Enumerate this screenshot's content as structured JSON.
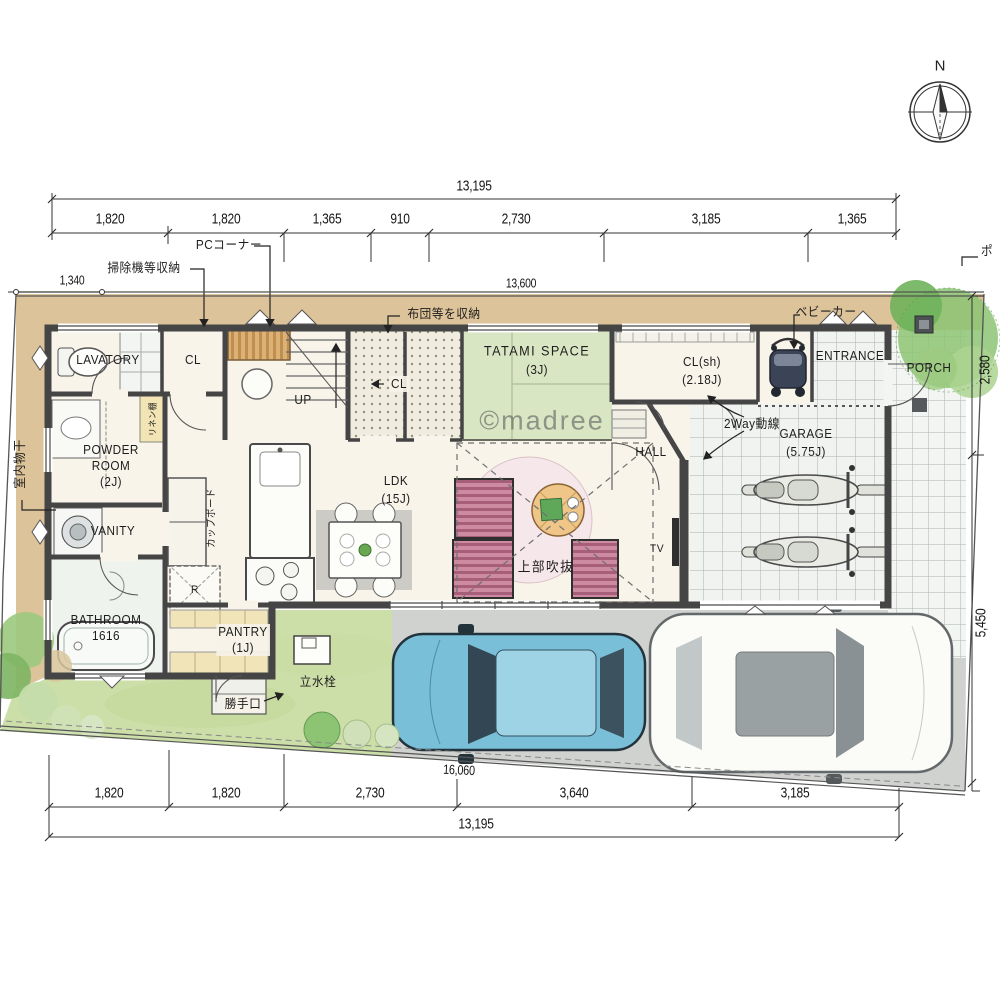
{
  "meta": {
    "watermark": "©madree",
    "compass_north": "N",
    "post_label": "ポ"
  },
  "dimensions": {
    "top_total": "13,195",
    "top_segments": [
      "1,820",
      "1,820",
      "1,365",
      "910",
      "2,730",
      "3,185",
      "1,365"
    ],
    "site_width": "13,600",
    "left_offset": "1,340",
    "right_upper": "2,580",
    "right_lower": "5,450",
    "bottom_diagonal": "16,060",
    "bottom_segments": [
      "1,820",
      "1,820",
      "2,730",
      "3,640",
      "3,185"
    ],
    "bottom_total": "13,195"
  },
  "rooms": {
    "lavatory": "LAVATORY",
    "closet_top": "CL",
    "stairs_up": "UP",
    "futon_closet": "CL",
    "tatami_name": "TATAMI SPACE",
    "tatami_size": "(3J)",
    "shoe_closet_name": "CL(sh)",
    "shoe_closet_size": "(2.18J)",
    "entrance": "ENTRANCE",
    "porch": "PORCH",
    "hall": "HALL",
    "garage_name": "GARAGE",
    "garage_size": "(5.75J)",
    "ldk_name": "LDK",
    "ldk_size": "(15J)",
    "powder_room": "POWDER\nROOM\n(2J)",
    "vanity": "VANITY",
    "bathroom": "BATHROOM\n1616",
    "pantry": "PANTRY\n(1J)",
    "fridge": "R",
    "tv": "TV"
  },
  "callouts": {
    "vacuum_storage": "掃除機等収納",
    "pc_corner": "PCコーナー",
    "futon_note": "布団等を収納",
    "stroller": "ベビーカー",
    "indoor_laundry": "室内物干",
    "void_above": "上部吹抜",
    "two_way_line": "2Way動線",
    "tap": "立水栓",
    "back_door": "勝手口",
    "cupboard": "カップボード",
    "linen_shelf": "リネン棚"
  },
  "colors": {
    "wall": "#454545",
    "tatami_green": "#d9e6c4",
    "sofa_pink": "#cd8aa0",
    "lawn_green": "#cddfa9",
    "driveway_gray": "#d0d2cf",
    "ground_tan": "#dbc093",
    "blue_car": "#7abfd8",
    "tile_line": "#a9b0ae"
  }
}
